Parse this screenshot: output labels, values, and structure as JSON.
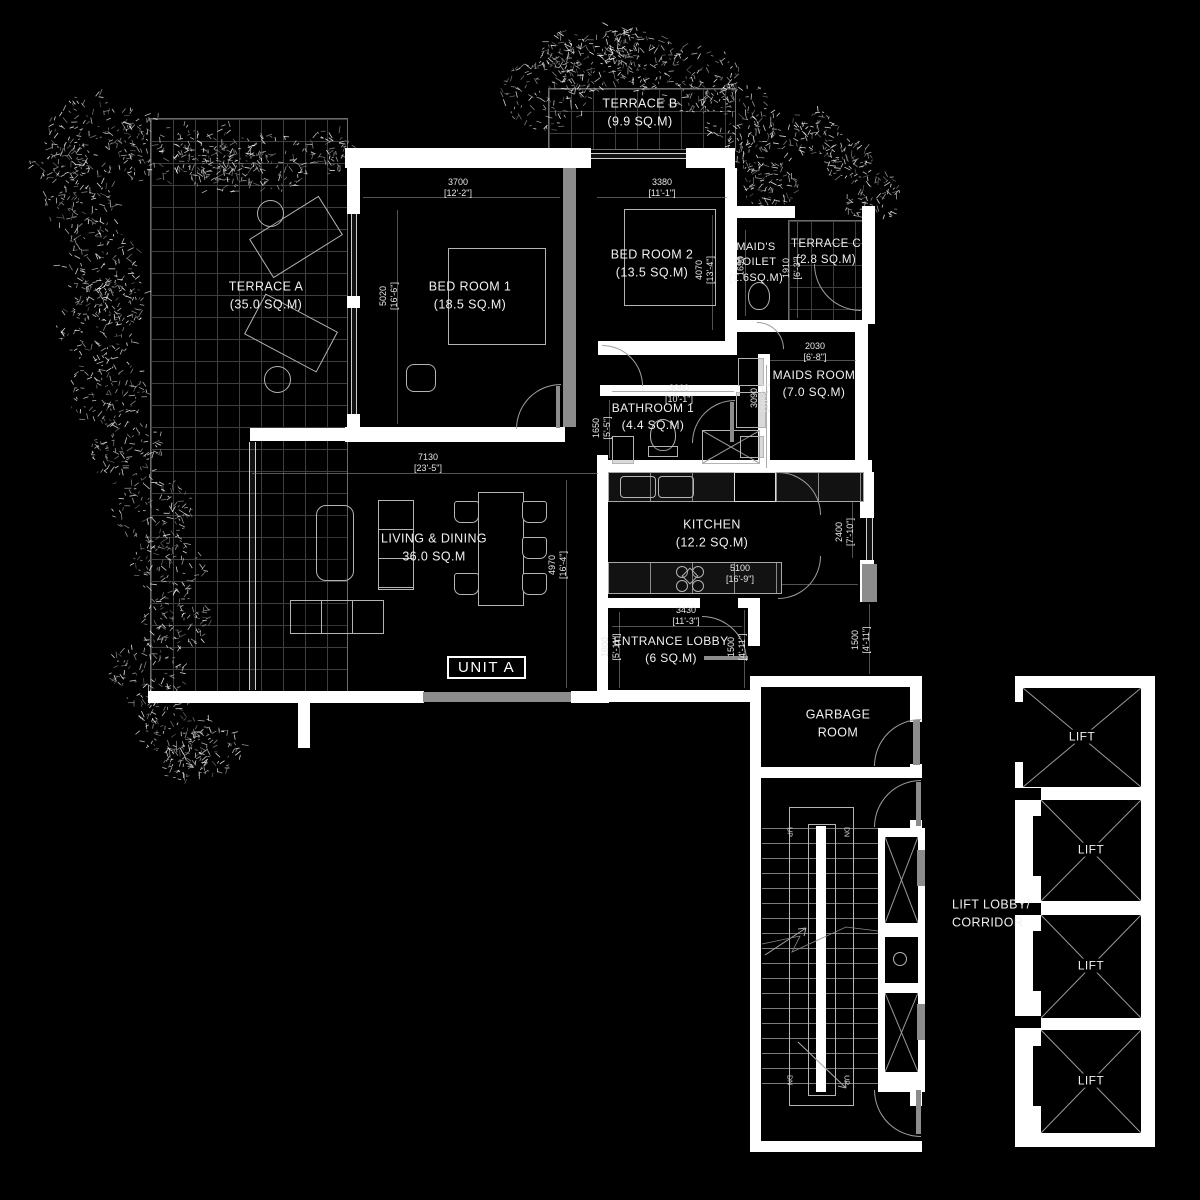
{
  "plan": {
    "unit_label": "UNIT A",
    "lift_label": "LIFT",
    "stairs": {
      "up": "UP",
      "dn": "DN"
    },
    "rooms": [
      {
        "name": "TERRACE B",
        "area": "(9.9 SQ.M)"
      },
      {
        "name": "TERRACE A",
        "area": "(35.0 SQ.M)"
      },
      {
        "name": "TERRACE C",
        "area": "(2.8 SQ.M)"
      },
      {
        "name": "BED ROOM 1",
        "area": "(18.5 SQ.M)"
      },
      {
        "name": "BED ROOM 2",
        "area": "(13.5 SQ.M)"
      },
      {
        "name": "MAID'S TOILET",
        "area": "(1.6SQ.M)"
      },
      {
        "name": "MAIDS ROOM",
        "area": "(7.0 SQ.M)"
      },
      {
        "name": "BATHROOM 1",
        "area": "(4.4 SQ.M)"
      },
      {
        "name": "KITCHEN",
        "area": "(12.2 SQ.M)"
      },
      {
        "name": "LIVING & DINING",
        "area": "36.0 SQ.M"
      },
      {
        "name": "ENTRANCE LOBBY",
        "area": "(6 SQ.M)"
      },
      {
        "name": "GARBAGE ROOM",
        "area": ""
      },
      {
        "name": "LIFT LOBBY/ CORRIDOR",
        "area": ""
      }
    ],
    "dimensions": [
      {
        "mm": "3700",
        "ft": "[12'-2\"]"
      },
      {
        "mm": "3380",
        "ft": "[11'-1\"]"
      },
      {
        "mm": "5020",
        "ft": "[16'-6\"]"
      },
      {
        "mm": "4070",
        "ft": "[13'-4\"]"
      },
      {
        "mm": "1910",
        "ft": "[6'-3\"]"
      },
      {
        "mm": "1690",
        "ft": ""
      },
      {
        "mm": "2030",
        "ft": "[6'-8\"]"
      },
      {
        "mm": "3090",
        "ft": "[10'-2\"]"
      },
      {
        "mm": "3060",
        "ft": "[10'-1\"]"
      },
      {
        "mm": "1650",
        "ft": "[5'-5\"]"
      },
      {
        "mm": "7130",
        "ft": "[23'-5\"]"
      },
      {
        "mm": "4970",
        "ft": "[16'-4\"]"
      },
      {
        "mm": "5100",
        "ft": "[16'-9\"]"
      },
      {
        "mm": "2400",
        "ft": "[7'-10\"]"
      },
      {
        "mm": "3430",
        "ft": "[11'-3\"]"
      },
      {
        "mm": "1800",
        "ft": "[5'-11\"]"
      },
      {
        "mm": "1500",
        "ft": "[4'-11\"]"
      },
      {
        "mm": "1500",
        "ft": "[4'-11\"]"
      }
    ],
    "colors": {
      "background": "#000000",
      "wall": "#ffffff",
      "partition": "#8c8c8c",
      "line": "#9a9a9a",
      "text": "#f0f0f0"
    }
  }
}
